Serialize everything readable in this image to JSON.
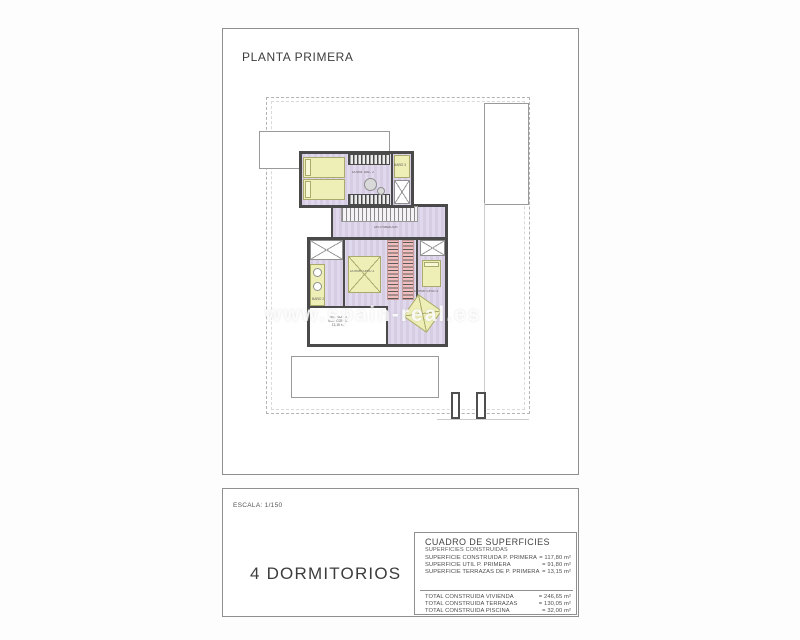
{
  "page": {
    "title": "PLANTA PRIMERA",
    "scale": "ESCALA: 1/150",
    "type_label": "4 DORMITORIOS",
    "watermark": "www.spain-real.es"
  },
  "rooms": {
    "dorm2": "DORM. DBL. 2",
    "bano3": "BAÑO 3",
    "distribuidor": "DISTRIBUIDOR",
    "dorm3": "DORMITORIO 3",
    "bano2": "BAÑO 2",
    "dorm4": "DORMITORIO 4",
    "terraza_line1": "TERRAZA 2",
    "terraza_line2": "SUP. CONST.",
    "terraza_line3": "13,15 m²"
  },
  "surface_table": {
    "title": "CUADRO DE SUPERFICIES",
    "subtitle": "SUPERFICIES CONSTRUIDAS",
    "rows": [
      {
        "label": "SUPERFICIE CONSTRUIDA P. PRIMERA",
        "value": "= 117,80 m²"
      },
      {
        "label": "SUPERFICIE UTIL P. PRIMERA",
        "value": "= 91,80 m²"
      },
      {
        "label": "SUPERFICIE TERRAZAS DE P. PRIMERA",
        "value": "= 13,15 m²"
      }
    ],
    "totals": [
      {
        "label": "TOTAL CONSTRUIDA VIVIENDA",
        "value": "= 246,65 m²"
      },
      {
        "label": "TOTAL CONSTRUIDA TERRAZAS",
        "value": "= 130,05 m²"
      },
      {
        "label": "TOTAL CONSTRUIDA PISCINA",
        "value": "= 32,00 m²"
      }
    ]
  },
  "colors": {
    "floor": "#dcd4e8",
    "furniture": "#eeefb6",
    "wardrobe_pink": "#f2bdbd",
    "wall": "#4a4a4a"
  }
}
